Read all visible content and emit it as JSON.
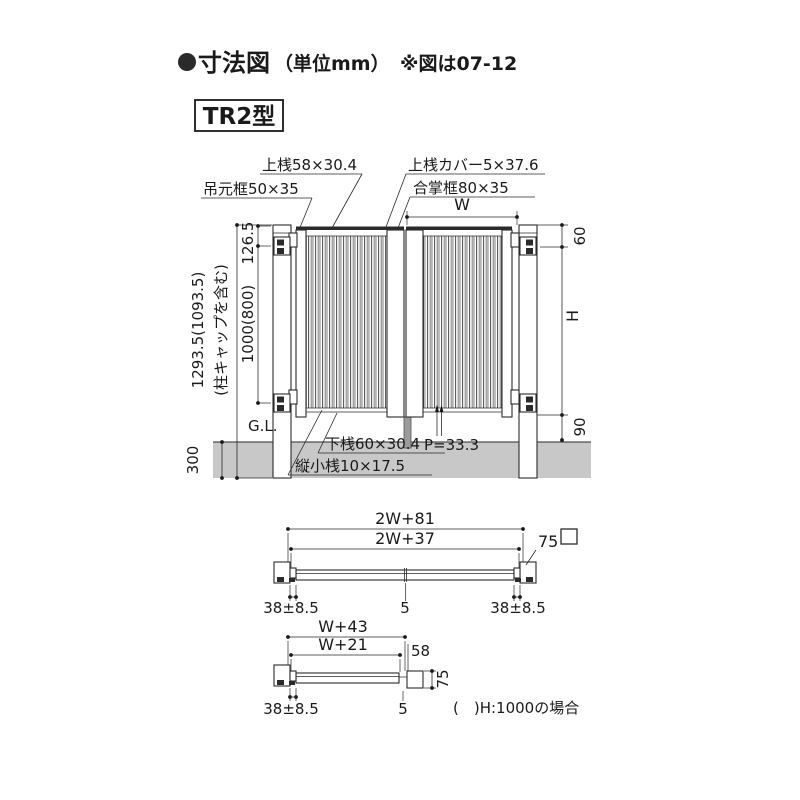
{
  "title": {
    "heading": "寸法図",
    "unit": "（単位mm）",
    "note": "※図は07-12"
  },
  "model": {
    "label": "TR2型"
  },
  "elevation": {
    "labels": {
      "hanging_stile": "吊元框50×35",
      "top_rail": "上桟58×30.4",
      "top_rail_cover": "上桟カバー5×37.6",
      "meeting_stile": "合掌框80×35",
      "bottom_rail": "下桟60×30.4",
      "vertical_slat": "縦小桟10×17.5",
      "pitch": "P=33.3"
    },
    "dims": {
      "w": "W",
      "top_offset": "60",
      "height": "H",
      "bottom_clearance": "90",
      "hinge_top": "126.5",
      "hinge_span": "1000(800)",
      "post_height": "1293.5(1093.5)",
      "post_height_note": "(柱キャップを含む)",
      "ground_line": "G.L.",
      "embed_depth": "300"
    }
  },
  "plan_double": {
    "dims": {
      "overall": "2W+81",
      "inner": "2W+37",
      "post_size": "75",
      "left_gap": "38±8.5",
      "center_gap": "5",
      "right_gap": "38±8.5"
    }
  },
  "plan_single": {
    "dims": {
      "overall": "W+43",
      "inner": "W+21",
      "stile": "58",
      "post_size": "75",
      "left_gap": "38±8.5",
      "center_gap": "5"
    },
    "note": "(　)H:1000の場合"
  },
  "colors": {
    "line": "#2a2a2a",
    "ground": "#c8c8c8",
    "cover": "#2a2a2a"
  }
}
